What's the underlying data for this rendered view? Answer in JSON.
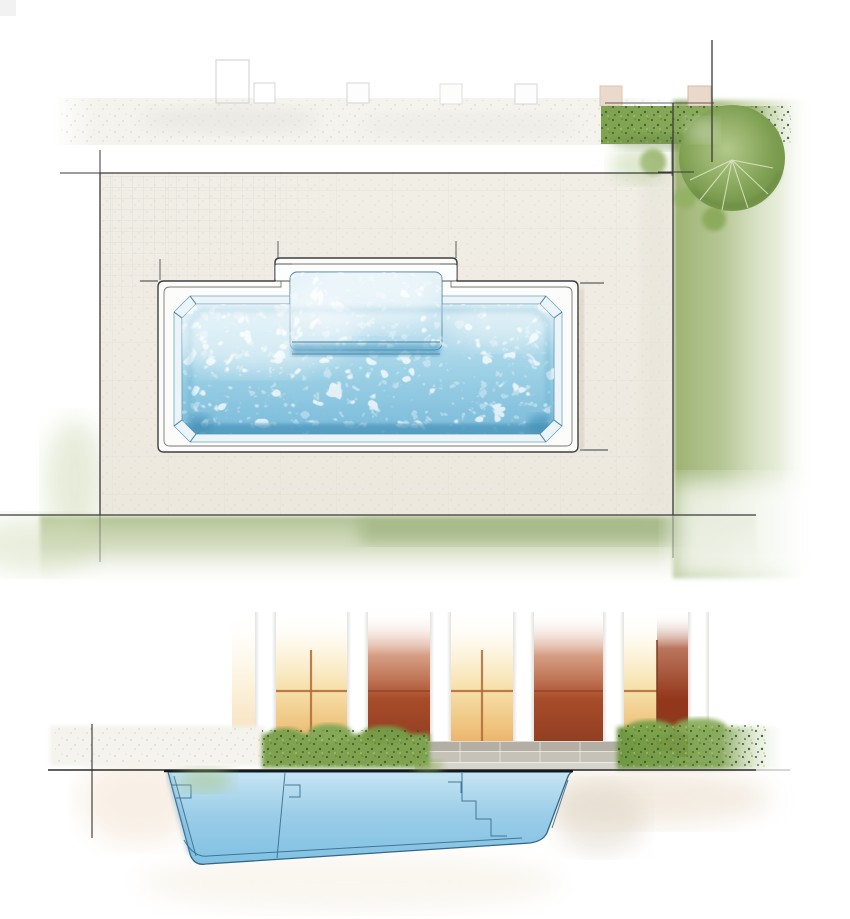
{
  "scene": {
    "type": "watercolor-architectural-illustration",
    "subject": "fiberglass swimming pool with tanning shelf",
    "views": [
      {
        "id": "plan",
        "label": "top-down plan view of pool, patio, hedge, tree and lawn"
      },
      {
        "id": "section",
        "label": "cross-section of pool basin with entry steps, pillared wall, hedges and stone steps"
      }
    ],
    "palette": {
      "ink": "#3a3a3a",
      "coping_line": "#3f3f3f",
      "water_light": "#d7ecf5",
      "water_mid": "#9fd2e6",
      "water_deep": "#74b7d8",
      "water_edge": "#4a7e99",
      "water_dark_band": "#4c94ba",
      "shelf_light": "#eaf6fa",
      "shelf_mid": "#abd7ea",
      "patio": "#efebe2",
      "patio_line": "#d8d2c6",
      "gravel": "#f4f3ee",
      "lawn": "#9db272",
      "lawn_soft": "#b5c495",
      "hedge": "#7ea24f",
      "hedge_dot": "#33531f",
      "tree_light": "#b3c98a",
      "tree_mid": "#7d9e50",
      "tree_dark": "#5d7f3a",
      "window_glow": "#f7e3b0",
      "window_deep": "#e7a558",
      "mullion": "#b06a36",
      "terracotta": "#a84c2a",
      "terracotta_deep": "#86391e",
      "pillar_edge": "#e2e2e0",
      "step_gray": "#b3afa4",
      "slab_gray": "#d7d4cc",
      "basin_light": "#c6e5f3",
      "basin_mid": "#9bcde8",
      "basin_deep": "#7fc0e2",
      "basin_line": "#33678a",
      "waterline": "#16191b",
      "shadow_warm": "#f2e2cf"
    }
  }
}
